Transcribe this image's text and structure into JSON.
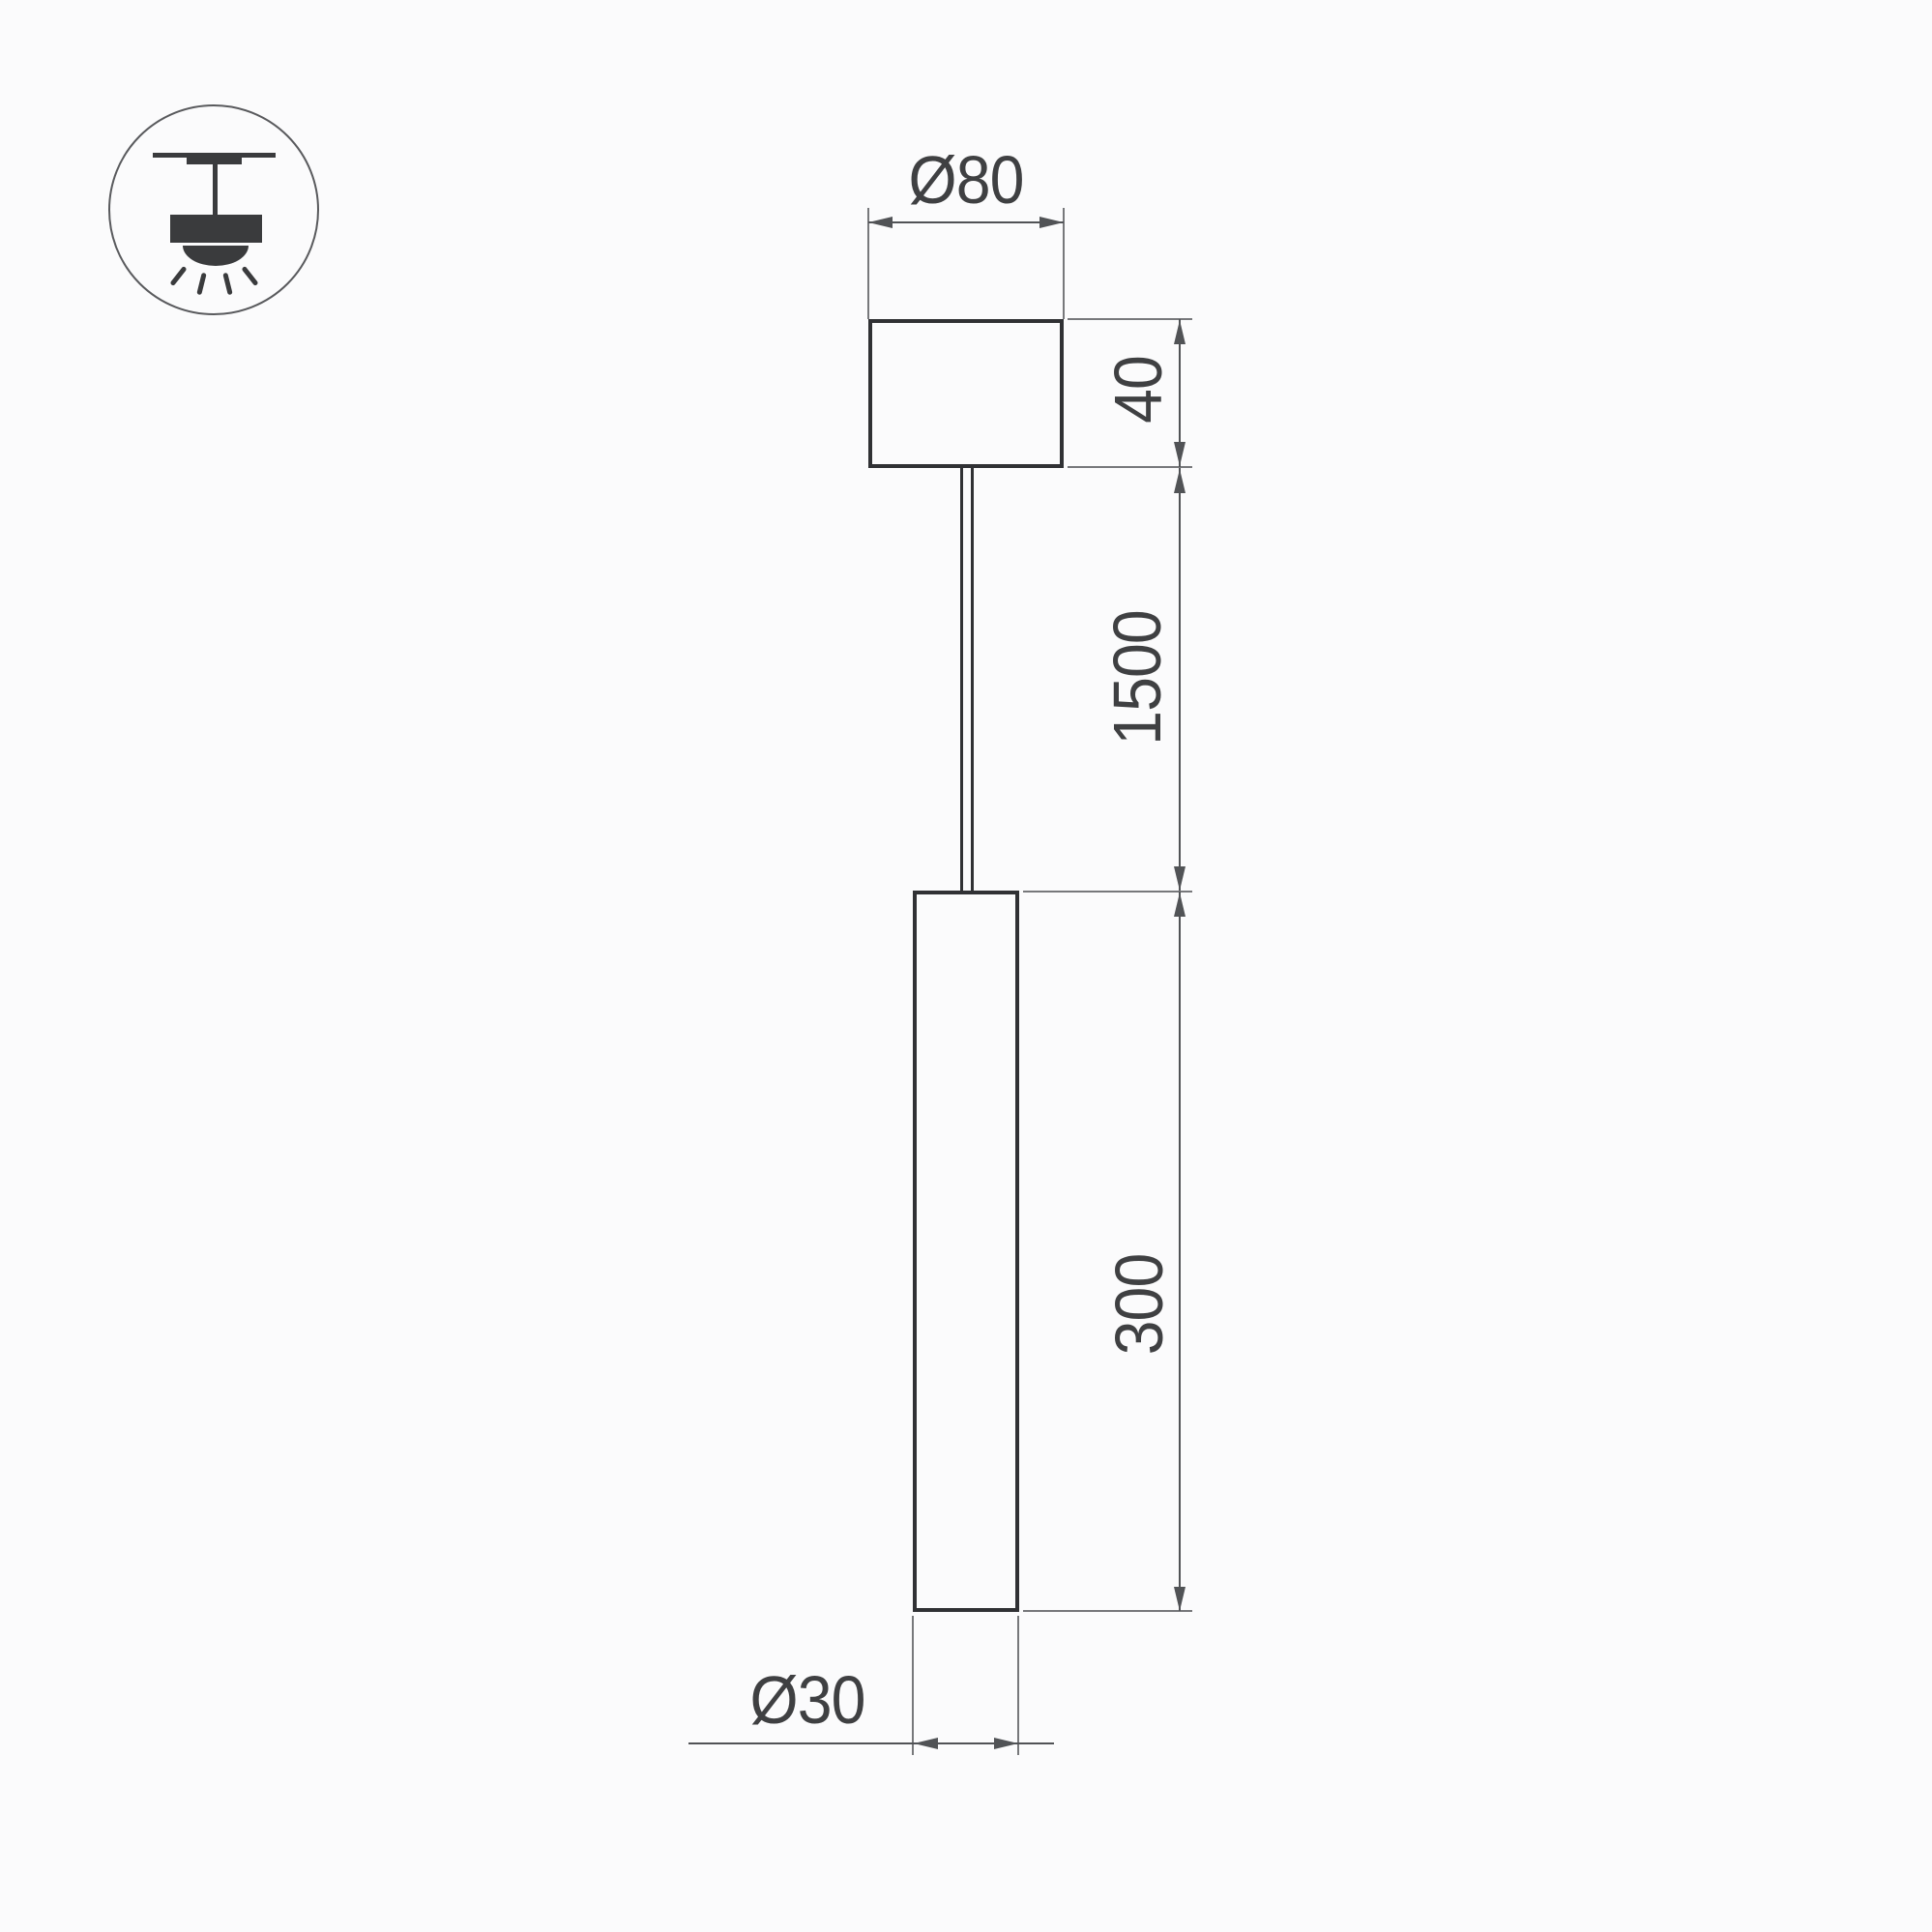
{
  "icon": {
    "name": "pendant-ceiling-mount-icon",
    "description": "surface ceiling mounted pendant luminaire pictogram"
  },
  "labels": {
    "canopy_diameter": "Ø80",
    "canopy_height": "40",
    "suspension_length": "1500",
    "tube_length": "300",
    "tube_diameter": "Ø30"
  },
  "colors": {
    "background": "#fbfbfc",
    "outline": "#303134",
    "dimension_line": "#515356",
    "extension_line": "#77787b",
    "label_text": "#3f4042",
    "icon_ink": "#3a3b3d"
  }
}
